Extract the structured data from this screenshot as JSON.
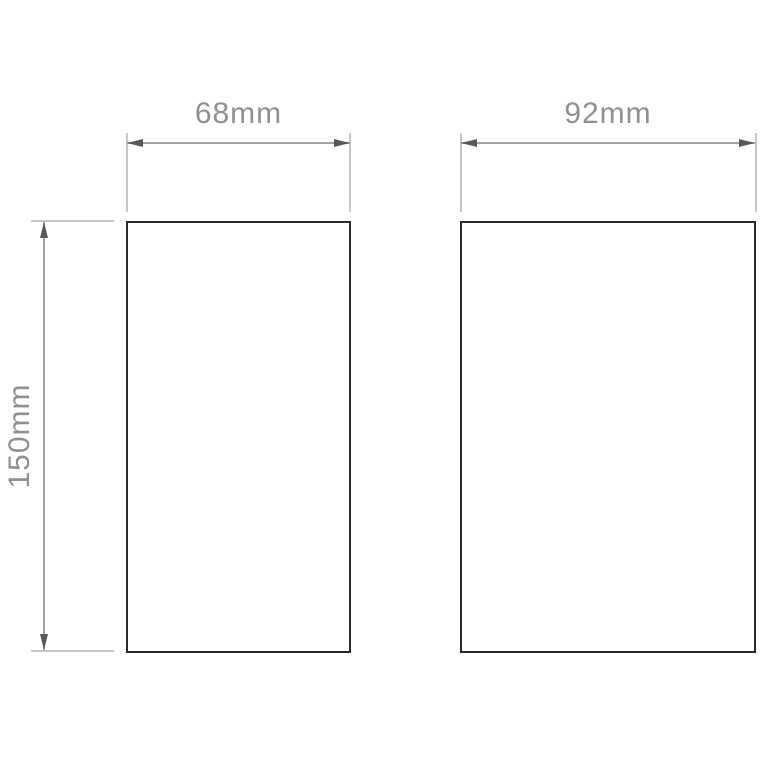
{
  "diagram": {
    "type": "technical-dimension-drawing",
    "labels": {
      "left_shape_width": "68mm",
      "left_shape_height": "150mm",
      "right_shape_width": "92mm"
    },
    "colors": {
      "background": "#ffffff",
      "shape_border": "#2b2b2b",
      "dimension_line": "#a3a3a3",
      "extension_line": "#c6c6c6",
      "arrow": "#585858",
      "label_text": "#8f8f8f"
    }
  }
}
